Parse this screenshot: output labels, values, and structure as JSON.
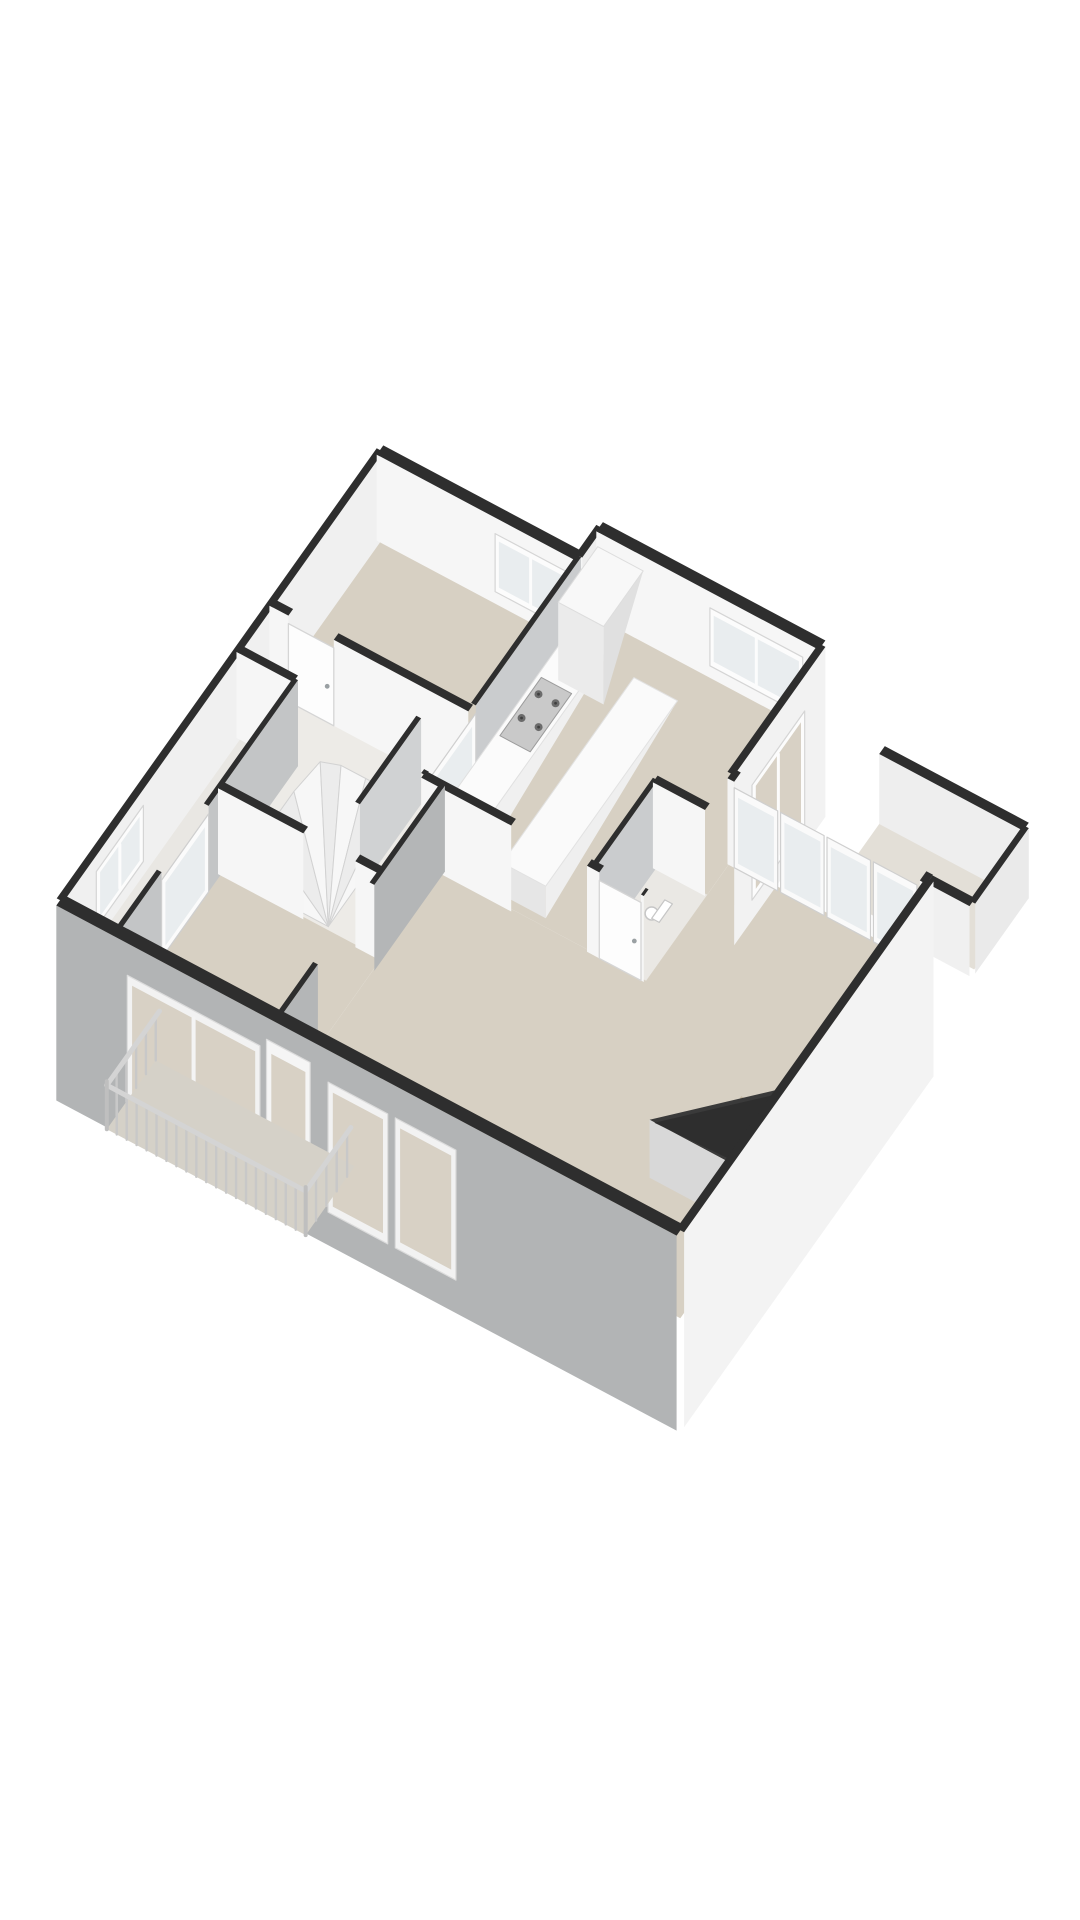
{
  "figure": {
    "kind": "3d-floorplan-render",
    "background": "#ffffff",
    "view": "axonometric-from-south"
  },
  "palette": {
    "wall_cap": "#2e2e2e",
    "wall_face_light": "#f6f6f6",
    "wall_face_soft": "#ededed",
    "wall_face_medium": "#caccce",
    "wall_face_gray": "#b4b6b7",
    "facade_sw": "#b2b4b5",
    "facade_se": "#f3f3f3",
    "floor_beige": "#d7d0c3",
    "floor_hall": "#edebe7",
    "floor_wc": "#eae8e4",
    "floor_west": "#e9e7e3",
    "floor_balcony_east": "#e3dfd7",
    "floor_balcony_sw": "#d5d1c8",
    "glass_interior": "#e9edef",
    "glass_facade": "#d8d1c5",
    "frame_white": "#fcfcfc",
    "frame_stroke": "#d5d5d5",
    "stair_tread": "#f7f7f7",
    "stair_tread_alt": "#ececec",
    "stair_stroke": "#d2d2d2",
    "riser": "#dedede",
    "railing": "#c8c8c8",
    "rail_top": "#d4d4d4",
    "counter_top": "#fbfbfb",
    "counter_face": "#e9e9e9",
    "cabinet_top": "#f8f8f8",
    "island_face": "#e6e6e6",
    "stove_base": "#c9c9c9",
    "stove_burner": "#6b6b6b",
    "stove_burner_center": "#3f3f3f",
    "void_face": "#d8d8d8",
    "void_steps": "#c2b49e",
    "toilet_white": "#ffffff",
    "toilet_stroke": "#c6c6c6"
  },
  "rooms": [
    {
      "name": "bedroom-north",
      "floor": "beige"
    },
    {
      "name": "kitchen-dining",
      "floor": "beige"
    },
    {
      "name": "wc",
      "floor": "light"
    },
    {
      "name": "hall-landing",
      "floor": "light"
    },
    {
      "name": "west-wing",
      "floor": "light"
    },
    {
      "name": "bedroom-southwest",
      "floor": "beige"
    },
    {
      "name": "living-room",
      "floor": "beige"
    },
    {
      "name": "balcony-east",
      "floor": "pale"
    },
    {
      "name": "balcony-southwest",
      "floor": "pale"
    }
  ],
  "features": [
    "winder-staircase",
    "straight-steps-down",
    "stairwell-void",
    "kitchen-counter-with-stove",
    "tall-cabinet",
    "kitchen-island",
    "toilet-fixture",
    "french-door-wall",
    "balcony-railing",
    "facade-windows",
    "interior-glazed-doors",
    "interior-door-leaves"
  ]
}
